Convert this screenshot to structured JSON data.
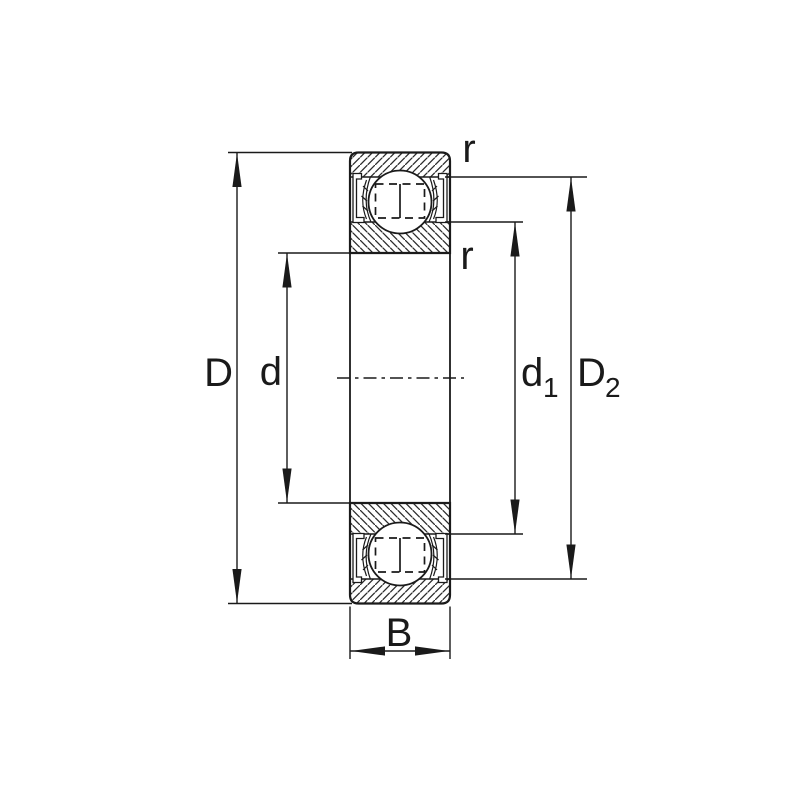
{
  "diagram": {
    "type": "bearing-cross-section-dimension-drawing",
    "colors": {
      "line": "#1a1a1a",
      "background": "#ffffff"
    },
    "labels": {
      "outer_diameter": "D",
      "bore_diameter": "d",
      "recess_diameter_base": "d",
      "recess_diameter_sub": "1",
      "shoulder_diameter_base": "D",
      "shoulder_diameter_sub": "2",
      "width": "B",
      "chamfer_outer": "r",
      "chamfer_inner": "r"
    }
  }
}
